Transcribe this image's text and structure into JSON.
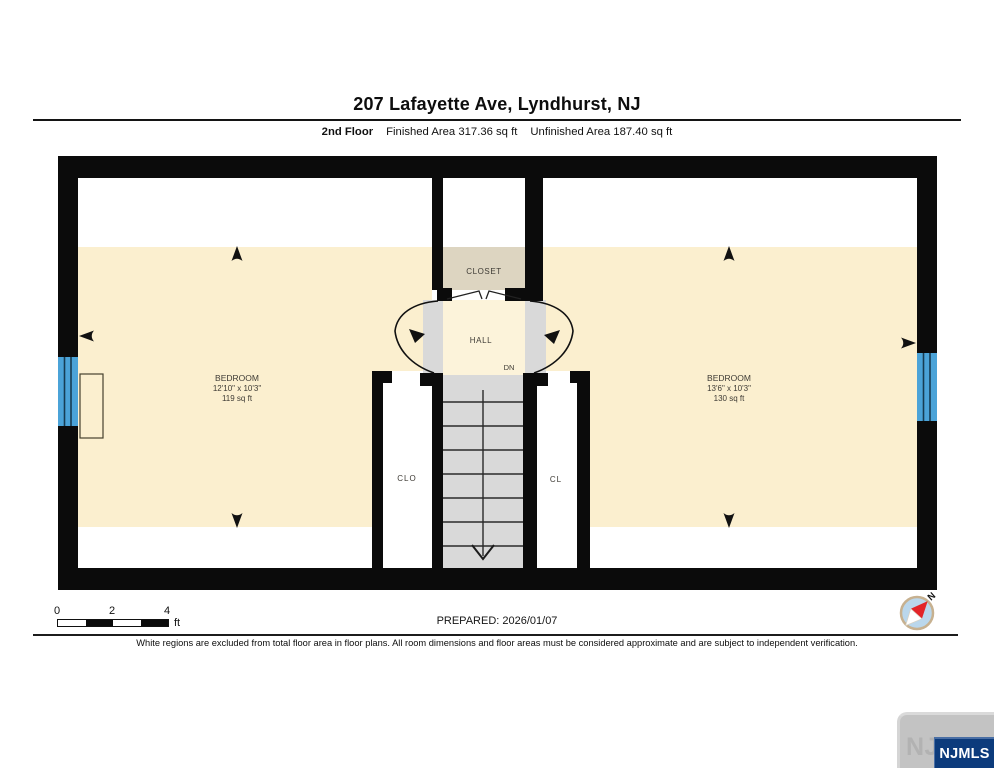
{
  "header": {
    "title": "207 Lafayette Ave, Lyndhurst, NJ",
    "floor_label": "2nd Floor",
    "finished_area": "Finished Area 317.36 sq ft",
    "unfinished_area": "Unfinished Area 187.40 sq ft"
  },
  "plan": {
    "closet_label": "CLOSET",
    "hall_label": "HALL",
    "down_label": "DN",
    "closet_left_label": "CLO",
    "closet_right_label": "CL",
    "bedroom_left": {
      "name": "BEDROOM",
      "dimensions": "12'10\" x 10'3\"",
      "area": "119 sq ft"
    },
    "bedroom_right": {
      "name": "BEDROOM",
      "dimensions": "13'6\" x 10'3\"",
      "area": "130 sq ft"
    },
    "colors": {
      "finished_floor": "#FBEFCF",
      "closet_floor": "#DDD5C1",
      "stairs_grey": "#D9D9D9",
      "window_blue": "#4BA3D8",
      "wall_black": "#0B0B0B"
    }
  },
  "footer": {
    "scale": {
      "tick0": "0",
      "tick2": "2",
      "tick4": "4",
      "unit": "ft"
    },
    "prepared": "PREPARED: 2026/01/07",
    "disclaimer": "White regions are excluded from total floor area in floor plans. All room dimensions and floor areas must be considered approximate and are subject to independent verification.",
    "compass": {
      "north_label": "N"
    },
    "logo": {
      "ghost_text": "NJMLS",
      "badge_text": "NJMLS"
    }
  }
}
